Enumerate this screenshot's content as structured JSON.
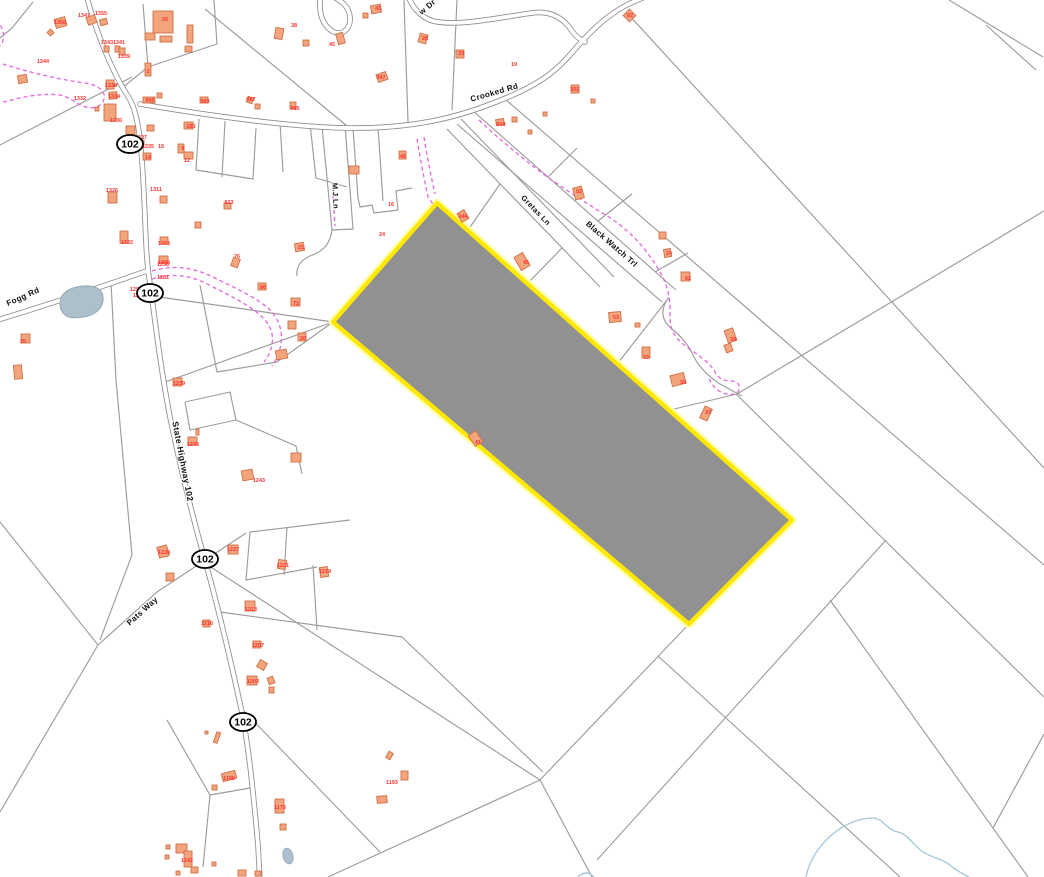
{
  "map": {
    "type": "parcel-gis-map",
    "colors": {
      "background": "#ffffff",
      "parcel_line": "#9c9c9c",
      "road_casing": "#8d8d8d",
      "road_fill": "#ffffff",
      "building_fill": "#f2a47d",
      "building_stroke": "#cf7148",
      "parcel_label": "#ff3333",
      "road_label": "#111111",
      "trail": "#e565de",
      "water_fill": "#adbfca",
      "water_stroke": "#93a9b6",
      "stream": "#a5c6da",
      "selected_fill": "#919191",
      "selected_stroke": "#ffe800",
      "selected_halo": "#ffffb0",
      "shield_stroke": "#000000",
      "shield_fill": "#ffffff"
    },
    "selected_parcel": {
      "points": "437,203 792,520 689,624 333,322"
    },
    "route_shields": [
      {
        "text": "102",
        "x": 130,
        "y": 144
      },
      {
        "text": "102",
        "x": 150,
        "y": 293
      },
      {
        "text": "102",
        "x": 205,
        "y": 559
      },
      {
        "text": "102",
        "x": 243,
        "y": 722
      }
    ],
    "road_labels": [
      {
        "text": "Fogg Rd",
        "x": 24,
        "y": 299,
        "rot": -24,
        "size": 8
      },
      {
        "text": "Crooked Rd",
        "x": 495,
        "y": 95,
        "rot": -16,
        "size": 8
      },
      {
        "text": "w Dr",
        "x": 429,
        "y": 9,
        "rot": -40,
        "size": 8
      },
      {
        "text": "State Highway 102",
        "x": 180,
        "y": 462,
        "rot": 79,
        "size": 8.5
      },
      {
        "text": "M.J Ln",
        "x": 333,
        "y": 196,
        "rot": 87,
        "size": 7.5
      },
      {
        "text": "Gretas Ln",
        "x": 534,
        "y": 212,
        "rot": 46,
        "size": 7.5
      },
      {
        "text": "Black Watch Trl",
        "x": 610,
        "y": 246,
        "rot": 41,
        "size": 8
      },
      {
        "text": "Pats Way",
        "x": 144,
        "y": 613,
        "rot": -42,
        "size": 8
      }
    ],
    "parcel_labels": [
      [
        "1344",
        43,
        63
      ],
      [
        "1356",
        60,
        24
      ],
      [
        "1347",
        84,
        17
      ],
      [
        "1355",
        101,
        15
      ],
      [
        "1343",
        107,
        44
      ],
      [
        "1341",
        119,
        44
      ],
      [
        "1339",
        124,
        58
      ],
      [
        "1338",
        111,
        87
      ],
      [
        "1334",
        114,
        98
      ],
      [
        "1332",
        80,
        100
      ],
      [
        "1336",
        116,
        122
      ],
      [
        "995",
        150,
        102
      ],
      [
        "983",
        205,
        103
      ],
      [
        "985",
        295,
        110
      ],
      [
        "987",
        251,
        101
      ],
      [
        "1337",
        141,
        139
      ],
      [
        "1335",
        148,
        148
      ],
      [
        "15",
        161,
        148
      ],
      [
        "14",
        148,
        159
      ],
      [
        "8",
        183,
        150
      ],
      [
        "12",
        187,
        162
      ],
      [
        "283",
        191,
        128
      ],
      [
        "2",
        148,
        73
      ],
      [
        "1311",
        156,
        191
      ],
      [
        "1326",
        112,
        192
      ],
      [
        "823",
        229,
        204
      ],
      [
        "21",
        301,
        249
      ],
      [
        "1322",
        127,
        244
      ],
      [
        "1303",
        164,
        245
      ],
      [
        "1305",
        164,
        264
      ],
      [
        "1281",
        163,
        279
      ],
      [
        "76",
        237,
        258
      ],
      [
        "86",
        263,
        289
      ],
      [
        "55",
        165,
        21
      ],
      [
        "38",
        294,
        27
      ],
      [
        "45",
        332,
        46
      ],
      [
        "43",
        378,
        10
      ],
      [
        "28",
        425,
        40
      ],
      [
        "23",
        461,
        55
      ],
      [
        "19",
        514,
        66
      ],
      [
        "347",
        381,
        79
      ],
      [
        "552",
        575,
        91
      ],
      [
        "82",
        630,
        17
      ],
      [
        "918",
        501,
        126
      ],
      [
        "46",
        403,
        158
      ],
      [
        "16",
        391,
        206
      ],
      [
        "24",
        382,
        236
      ],
      [
        "246",
        463,
        218
      ],
      [
        "45",
        526,
        264
      ],
      [
        "41",
        478,
        444
      ],
      [
        "52",
        579,
        193
      ],
      [
        "24",
        669,
        255
      ],
      [
        "62",
        688,
        280
      ],
      [
        "39",
        733,
        341
      ],
      [
        "53",
        616,
        319
      ],
      [
        "33",
        646,
        359
      ],
      [
        "35",
        683,
        384
      ],
      [
        "37",
        708,
        414
      ],
      [
        "25",
        23,
        343
      ],
      [
        "72",
        296,
        305
      ],
      [
        "20",
        303,
        340
      ],
      [
        "1290",
        136,
        291
      ],
      [
        "1288",
        139,
        297
      ],
      [
        "1296",
        163,
        266
      ],
      [
        "1239",
        179,
        385
      ],
      [
        "1235",
        193,
        446
      ],
      [
        "1243",
        259,
        482
      ],
      [
        "1228",
        164,
        554
      ],
      [
        "1227",
        233,
        551
      ],
      [
        "1221",
        283,
        567
      ],
      [
        "1219",
        325,
        573
      ],
      [
        "1213",
        251,
        611
      ],
      [
        "1216",
        207,
        625
      ],
      [
        "1207",
        258,
        647
      ],
      [
        "1203",
        253,
        683
      ],
      [
        "1186",
        229,
        780
      ],
      [
        "1173",
        280,
        809
      ],
      [
        "1193",
        392,
        784
      ],
      [
        "1142",
        187,
        862
      ]
    ],
    "roads": [
      "M 86,-6 C 96,32 112,72 129,98 C 139,114 142,150 144,196 C 146,238 146,260 150,284 C 155,320 161,372 171,422 C 181,470 194,522 206,564 C 218,607 231,662 241,708 C 249,747 254,800 258,845 L 260,882",
      "M 140,104 C 212,116 292,127 347,128 C 412,129 457,118 501,100 C 536,86 553,74 569,56 C 586,36 606,14 633,2 L 656,-8",
      "M -6,321 C 32,310 82,293 112,283 C 127,278 137,274 147,271",
      "M 407,-7 C 411,5 419,17 433,21 C 457,27 502,17 532,13 C 552,10 564,19 572,31 C 576,37 581,40 585,42",
      "M 321,-5 C 318,9 321,24 332,31 C 342,37 351,29 350,17 C 349,7 342,1 332,-4"
    ],
    "parcel_lines": [
      "M 0,145 L 132,77",
      "M 33,2 L 12,28 L 0,38",
      "M 143,4 L 148,67 L 217,44 L 214,0",
      "M 148,67 L 122,88",
      "M 205,9 L 347,126",
      "M 199,119 L 196,170 L 253,179 L 256,128",
      "M 225,121 L 222,177",
      "M 280,122 L 283,172",
      "M 310,124 L 316,178 L 347,187",
      "M 322,126 L 332,230 L 353,229 L 345,125",
      "M 332,230 C 330,245 322,252 310,256 C 300,260 296,268 297,276",
      "M 353,128 L 358,198 L 360,207 L 372,205 L 374,213 L 398,210 L 396,191 L 412,188",
      "M 378,127 L 383,201",
      "M 404,0 L 408,122",
      "M 457,0 L 452,110",
      "M 628,14 L 1044,468",
      "M 505,99 L 1044,565",
      "M 949,0 L 1043,57",
      "M 986,25 L 1036,70",
      "M 737,394 L 1044,211",
      "M 736,394 L 1044,697",
      "M 447,129 L 600,287",
      "M 461,119 L 614,277",
      "M 472,110 L 676,290",
      "M 457,124 L 662,302",
      "M 669,297 C 660,309 661,320 671,328 C 681,336 688,344 693,355 C 698,366 708,376 720,384 L 742,396",
      "M 548,177 L 577,148",
      "M 598,221 L 632,194",
      "M 655,272 L 688,253",
      "M 500,184 L 468,230",
      "M 562,248 L 528,283",
      "M 618,363 L 667,300",
      "M 670,410 L 737,394",
      "M 206,564 L 540,780",
      "M 689,624 L 540,780",
      "M 540,780 L 592,877",
      "M 540,780 L 328,877",
      "M 241,708 L 380,852",
      "M 220,612 L 402,637 L 543,772",
      "M 658,656 L 900,877",
      "M 597,860 L 886,540",
      "M 830,600 L 1028,877",
      "M 993,828 L 1044,734",
      "M 313,565 L 317,630",
      "M 250,532 L 246,580 L 317,567",
      "M 287,527 L 284,575",
      "M 250,532 L 350,520",
      "M 98,645 L 157,592 L 246,533",
      "M 0,522 L 98,645 L 0,812",
      "M 167,720 L 210,795 L 203,867",
      "M 210,795 L 250,788",
      "M 111,282 L 116,380 L 126,490 L 132,555 L 100,640",
      "M 152,296 L 230,307 L 333,322",
      "M 165,382 L 333,322",
      "M 200,285 L 217,372 L 277,362 L 333,322",
      "M 185,402 L 230,392 L 236,420 L 190,430 L 185,402",
      "M 236,420 L 296,446 L 302,474"
    ],
    "trails": [
      "M -4,62 C 25,71 55,79 85,83 C 98,85 106,91 104,99 C 102,107 92,110 83,106 C 75,103 70,97 60,95 C 45,93 25,96 8,101 C 4,102 0,103 -4,104",
      "M -4,20 C 2,26 5,33 3,40 C 2,45 -2,48 -6,48",
      "M 417,139 C 420,158 424,178 428,197 L 433,204",
      "M 424,137 C 427,156 431,176 435,194",
      "M 152,271 C 175,264 195,268 215,278 C 235,288 255,297 268,308 C 278,317 283,330 281,343 C 280,352 276,360 272,366",
      "M 152,279 C 175,272 193,276 211,286 C 231,296 249,305 261,316 C 270,324 274,334 272,344 C 271,351 268,357 264,362",
      "M 332,182 L 335,226",
      "M 479,120 C 500,140 522,158 546,176 C 566,190 586,203 604,214 C 621,224 639,240 651,258 C 661,272 667,284 669,297 C 671,308 669,318 671,326 C 673,336 681,343 691,350 C 701,357 711,364 715,372 C 718,378 723,381 731,381 C 737,381 741,385 739,390 C 737,395 729,396 721,392 C 715,389 711,384 709,378"
    ],
    "water": {
      "pond": "M 62,296 C 66,289 78,285 90,286 C 100,287 104,293 103,301 C 102,309 94,316 83,317 C 74,318 69,319 64,314 C 59,309 59,302 62,296 Z",
      "pond_small": {
        "cx": 288,
        "cy": 856,
        "rx": 5,
        "ry": 8,
        "rot": -15
      },
      "streams": [
        "M 578,877 Q 586,869 594,877",
        "M 806,877 C 810,856 824,841 834,833 C 845,824 860,818 872,818 C 884,818 886,830 898,832 C 908,834 913,845 923,852 C 933,858 945,860 951,866 C 957,871 963,874 969,877"
      ]
    },
    "buildings": [
      [
        153,
        11,
        20,
        22,
        0
      ],
      [
        145,
        33,
        10,
        7,
        0
      ],
      [
        160,
        36,
        12,
        6,
        0
      ],
      [
        187,
        25,
        6,
        18,
        0
      ],
      [
        185,
        46,
        7,
        6,
        0
      ],
      [
        48,
        30,
        5,
        5,
        45
      ],
      [
        55,
        18,
        11,
        9,
        -15
      ],
      [
        87,
        16,
        9,
        8,
        -20
      ],
      [
        100,
        19,
        7,
        6,
        -15
      ],
      [
        104,
        46,
        5,
        6,
        0
      ],
      [
        115,
        46,
        5,
        6,
        0
      ],
      [
        119,
        48,
        6,
        7,
        0
      ],
      [
        18,
        75,
        9,
        8,
        -10
      ],
      [
        106,
        80,
        8,
        9,
        0
      ],
      [
        109,
        92,
        8,
        7,
        -5
      ],
      [
        104,
        104,
        12,
        17,
        0
      ],
      [
        95,
        107,
        4,
        4,
        0
      ],
      [
        143,
        97,
        12,
        6,
        0
      ],
      [
        157,
        93,
        5,
        5,
        0
      ],
      [
        200,
        97,
        8,
        6,
        0
      ],
      [
        290,
        102,
        6,
        7,
        0
      ],
      [
        255,
        104,
        5,
        5,
        0
      ],
      [
        247,
        97,
        6,
        6,
        20
      ],
      [
        126,
        126,
        9,
        10,
        0
      ],
      [
        147,
        125,
        7,
        6,
        0
      ],
      [
        136,
        140,
        8,
        7,
        0
      ],
      [
        143,
        153,
        8,
        7,
        0
      ],
      [
        178,
        144,
        6,
        9,
        0
      ],
      [
        184,
        152,
        9,
        7,
        0
      ],
      [
        184,
        122,
        9,
        7,
        0
      ],
      [
        145,
        63,
        6,
        13,
        0
      ],
      [
        160,
        196,
        7,
        7,
        0
      ],
      [
        108,
        192,
        9,
        11,
        0
      ],
      [
        224,
        203,
        7,
        6,
        0
      ],
      [
        195,
        222,
        6,
        6,
        0
      ],
      [
        295,
        243,
        9,
        8,
        -10
      ],
      [
        120,
        231,
        8,
        12,
        0
      ],
      [
        160,
        237,
        8,
        7,
        0
      ],
      [
        159,
        256,
        9,
        7,
        0
      ],
      [
        232,
        258,
        7,
        9,
        20
      ],
      [
        258,
        283,
        8,
        7,
        0
      ],
      [
        337,
        33,
        7,
        11,
        -15
      ],
      [
        275,
        28,
        8,
        11,
        10
      ],
      [
        303,
        40,
        6,
        6,
        0
      ],
      [
        371,
        5,
        10,
        8,
        -10
      ],
      [
        363,
        13,
        5,
        5,
        0
      ],
      [
        419,
        34,
        8,
        9,
        15
      ],
      [
        456,
        50,
        8,
        8,
        0
      ],
      [
        377,
        73,
        10,
        8,
        -20
      ],
      [
        571,
        85,
        8,
        8,
        0
      ],
      [
        591,
        99,
        4,
        4,
        0
      ],
      [
        625,
        11,
        9,
        9,
        45
      ],
      [
        496,
        119,
        8,
        6,
        -10
      ],
      [
        512,
        117,
        5,
        5,
        0
      ],
      [
        528,
        130,
        4,
        4,
        0
      ],
      [
        543,
        112,
        4,
        4,
        0
      ],
      [
        399,
        151,
        7,
        8,
        0
      ],
      [
        349,
        166,
        10,
        8,
        0
      ],
      [
        459,
        211,
        8,
        10,
        -30
      ],
      [
        517,
        254,
        10,
        15,
        -30
      ],
      [
        471,
        432,
        9,
        13,
        -33
      ],
      [
        574,
        187,
        9,
        12,
        -15
      ],
      [
        659,
        232,
        7,
        7,
        0
      ],
      [
        664,
        249,
        7,
        8,
        -10
      ],
      [
        681,
        272,
        9,
        9,
        0
      ],
      [
        609,
        312,
        12,
        10,
        -5
      ],
      [
        635,
        323,
        5,
        4,
        0
      ],
      [
        642,
        347,
        8,
        11,
        0
      ],
      [
        671,
        374,
        14,
        11,
        -15
      ],
      [
        702,
        407,
        8,
        13,
        25
      ],
      [
        726,
        329,
        9,
        13,
        -20
      ],
      [
        725,
        344,
        7,
        8,
        -20
      ],
      [
        291,
        298,
        9,
        8,
        0
      ],
      [
        288,
        321,
        8,
        8,
        0
      ],
      [
        298,
        333,
        8,
        8,
        0
      ],
      [
        276,
        350,
        11,
        9,
        -10
      ],
      [
        21,
        334,
        9,
        9,
        0
      ],
      [
        14,
        365,
        8,
        14,
        -5
      ],
      [
        173,
        378,
        9,
        8,
        0
      ],
      [
        188,
        437,
        9,
        8,
        0
      ],
      [
        196,
        429,
        3,
        6,
        0
      ],
      [
        242,
        470,
        11,
        10,
        -10
      ],
      [
        291,
        453,
        10,
        9,
        0
      ],
      [
        158,
        546,
        10,
        11,
        -15
      ],
      [
        166,
        573,
        8,
        8,
        0
      ],
      [
        228,
        545,
        10,
        9,
        0
      ],
      [
        278,
        560,
        8,
        9,
        10
      ],
      [
        320,
        567,
        8,
        10,
        -10
      ],
      [
        245,
        601,
        10,
        10,
        0
      ],
      [
        203,
        620,
        7,
        7,
        0
      ],
      [
        253,
        641,
        8,
        7,
        0
      ],
      [
        258,
        661,
        8,
        8,
        30
      ],
      [
        247,
        676,
        10,
        9,
        0
      ],
      [
        268,
        677,
        6,
        7,
        -20
      ],
      [
        269,
        687,
        5,
        6,
        0
      ],
      [
        222,
        772,
        14,
        8,
        -15
      ],
      [
        212,
        785,
        5,
        5,
        0
      ],
      [
        215,
        732,
        4,
        11,
        20
      ],
      [
        205,
        731,
        3,
        3,
        0
      ],
      [
        275,
        799,
        9,
        14,
        0
      ],
      [
        280,
        824,
        6,
        6,
        0
      ],
      [
        387,
        752,
        5,
        7,
        30
      ],
      [
        401,
        771,
        7,
        9,
        0
      ],
      [
        377,
        796,
        10,
        7,
        -5
      ],
      [
        176,
        844,
        11,
        9,
        0
      ],
      [
        184,
        851,
        8,
        16,
        0
      ],
      [
        191,
        867,
        7,
        6,
        0
      ],
      [
        166,
        845,
        4,
        4,
        0
      ],
      [
        165,
        855,
        4,
        4,
        0
      ],
      [
        176,
        871,
        4,
        4,
        0
      ],
      [
        212,
        862,
        4,
        4,
        0
      ],
      [
        238,
        870,
        8,
        6,
        0
      ],
      [
        255,
        871,
        6,
        5,
        0
      ]
    ]
  }
}
